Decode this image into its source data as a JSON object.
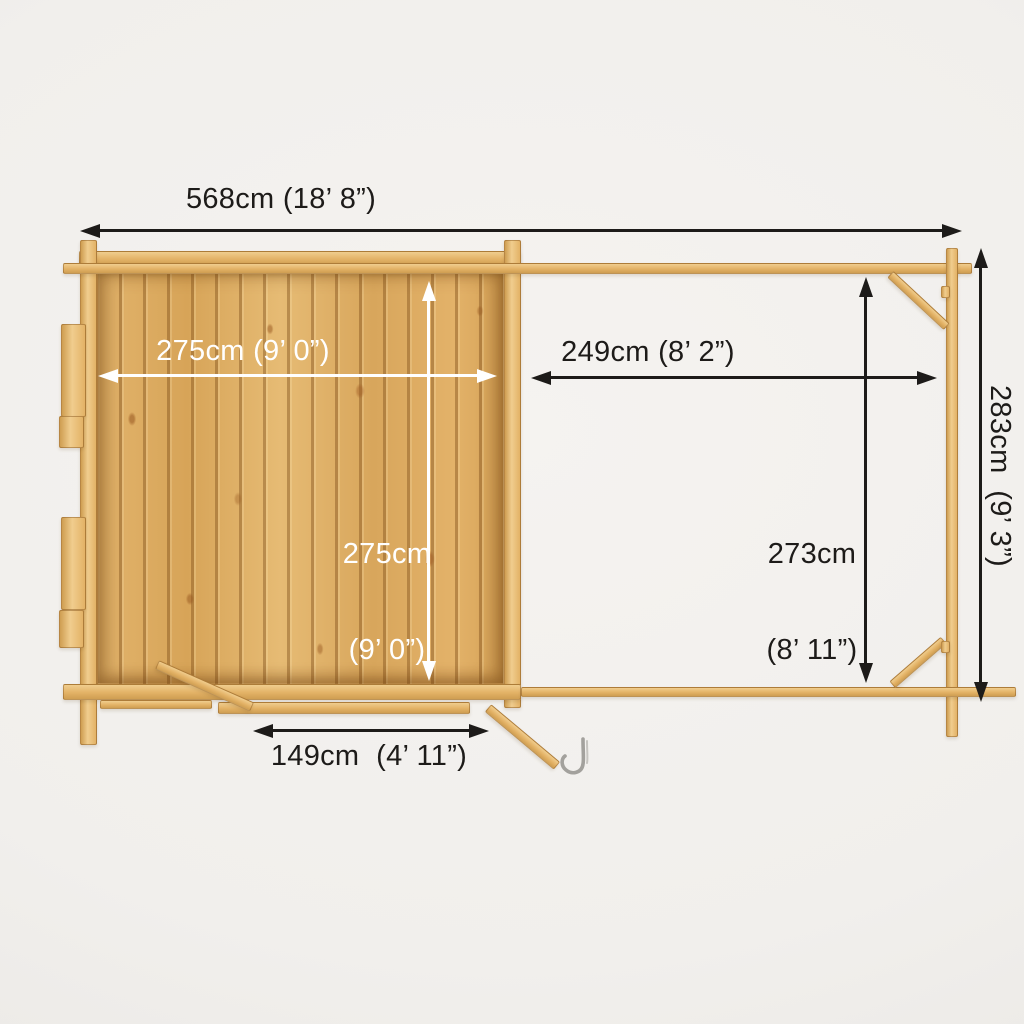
{
  "figure": {
    "type": "product-dimension-plan",
    "subject": "log cabin with side pergola, top-down plan view"
  },
  "dimensions": {
    "overall_width": {
      "label": "568cm (18’ 8”)"
    },
    "overall_depth": {
      "label": "283cm  (9’ 3”)"
    },
    "cabin_internal_width": {
      "label": "275cm (9’ 0”)"
    },
    "cabin_internal_depth": {
      "line1": "275cm",
      "line2": "(9’ 0”)"
    },
    "pergola_width": {
      "label": "249cm (8’ 2”)"
    },
    "pergola_depth": {
      "line1": "273cm",
      "line2": "(8’ 11”)"
    },
    "door_opening_width": {
      "label": "149cm  (4’ 11”)"
    }
  },
  "colors": {
    "background": "#f1efec",
    "wood_light": "#f0cd8e",
    "wood_main": "#e3b266",
    "wood_dark": "#cf9e52",
    "floor_main": "#dcaa60",
    "floor_groove": "#a97b3a",
    "dim_black": "#1d1b19",
    "dim_white": "#ffffff",
    "metal": "#a3a19d"
  }
}
